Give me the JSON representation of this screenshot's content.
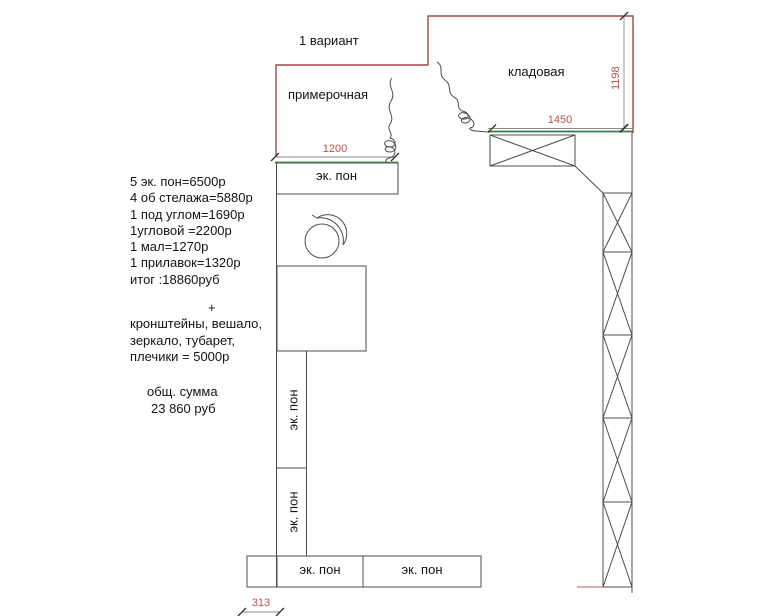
{
  "title": "1 вариант",
  "rooms": {
    "fitting_room": "примерочная",
    "storage_room": "кладовая"
  },
  "dimensions": {
    "wall_height_right": "1198",
    "storage_shelf_width": "1450",
    "fitting_panel_width": "1200",
    "bottom_offset": "313"
  },
  "panel_label": "эк. пон",
  "estimate": {
    "items": [
      "5 эк. пон=6500р",
      "4 об стелажа=5880р",
      "1 под углом=1690р",
      "1угловой =2200р",
      "1 мал=1270р",
      "1 прилавок=1320р",
      "итог :18860руб"
    ],
    "plus_sign": "+",
    "extras": [
      "кронштейны, вешало,",
      "зеркало, тубарет,",
      "плечики = 5000р"
    ],
    "total_caption": "общ. сумма",
    "total_value": "23 860 руб"
  },
  "colors": {
    "wall": "#a64545",
    "dimension_text": "#b5524e",
    "panel_line": "#3f7a4a",
    "drawing_line": "#4d4d4d"
  }
}
